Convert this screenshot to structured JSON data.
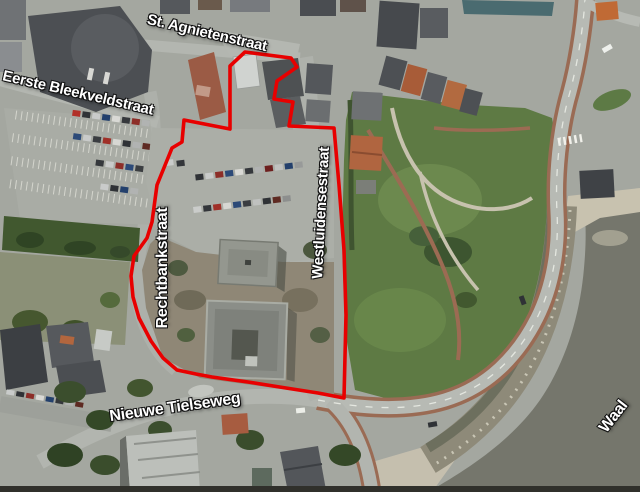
{
  "map": {
    "description_labels": {
      "st_agnietenstraat": "St. Agnietenstraat",
      "eerste_bleekveldstraat": "Eerste Bleekveldstraat",
      "rechtbankstraat": "Rechtbankstraat",
      "westluidensestraat": "Westluidensestraat",
      "nieuwe_tielseweg": "Nieuwe Tielseweg",
      "waal": "Waal"
    },
    "colors": {
      "boundary": "#e80000",
      "label_text": "#ffffff",
      "label_outline": "#000000",
      "water": "#75766c",
      "park_green": "#5e7a44",
      "pavement": "#a4a7a0"
    }
  }
}
